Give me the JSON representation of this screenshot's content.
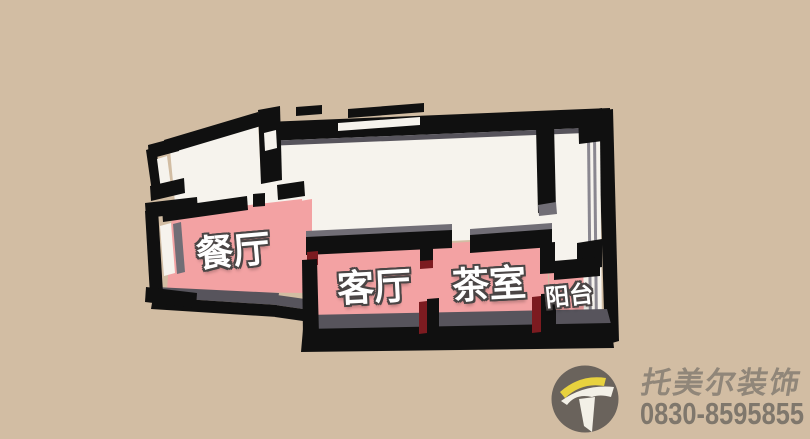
{
  "scene": {
    "description": "3D top-down floor plan render on tan background with highlighted living areas",
    "floor_plan": {
      "rooms": [
        {
          "id": "dining-room",
          "label": "餐厅",
          "highlighted": true
        },
        {
          "id": "living-room",
          "label": "客厅",
          "highlighted": true
        },
        {
          "id": "tea-room",
          "label": "茶室",
          "highlighted": true
        },
        {
          "id": "balcony",
          "label": "阳台",
          "highlighted": true
        }
      ]
    }
  },
  "watermark": {
    "logo_icon": "t-swoosh-icon",
    "company": "托美尔装饰",
    "phone": "0830-8595855"
  },
  "colors": {
    "background": "#d2bda3",
    "floor": "#f6f3ed",
    "highlight": "#f3a2a3",
    "wall": "#101010",
    "wall_face": "#57545c",
    "wall_light": "#716e76",
    "glass_line": "#8a8790",
    "accent_red": "#7c1b20",
    "label_text": "#ffffff",
    "label_outline": "#4a4545",
    "logo_circle": "#6a635c",
    "logo_yellow": "#e8d23e",
    "logo_white": "#f3f0e7",
    "company_text": "#8d8477",
    "phone_text": "#7b746a"
  }
}
